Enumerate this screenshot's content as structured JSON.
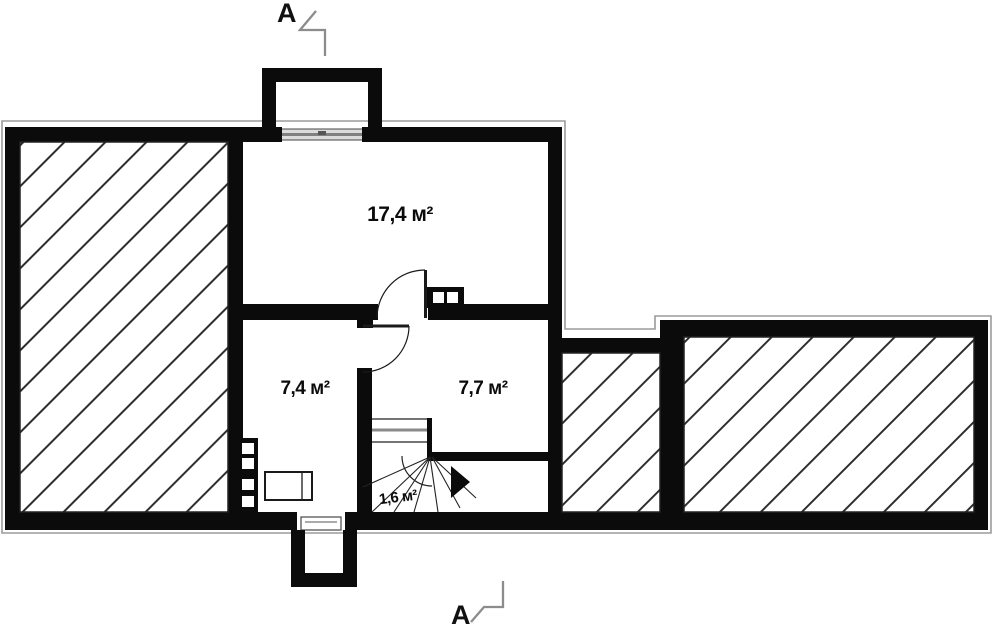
{
  "plan": {
    "section_marker_top": "A",
    "section_marker_bottom": "A",
    "rooms": [
      {
        "name": "room-top-large",
        "area": "17,4 м²"
      },
      {
        "name": "room-bottom-left",
        "area": "7,4 м²"
      },
      {
        "name": "room-bottom-right",
        "area": "7,7 м²"
      },
      {
        "name": "stair-landing",
        "area": "1,6 м²"
      }
    ],
    "colors": {
      "background": "#ffffff",
      "wall": "#0b0b0b",
      "hatch_line": "#2e2e2e",
      "outline": "#9b9b9b",
      "section_line": "#8c8c8c",
      "thin_line": "#222222",
      "window_fill": "#dcdcdc",
      "window_line": "#808080"
    }
  }
}
